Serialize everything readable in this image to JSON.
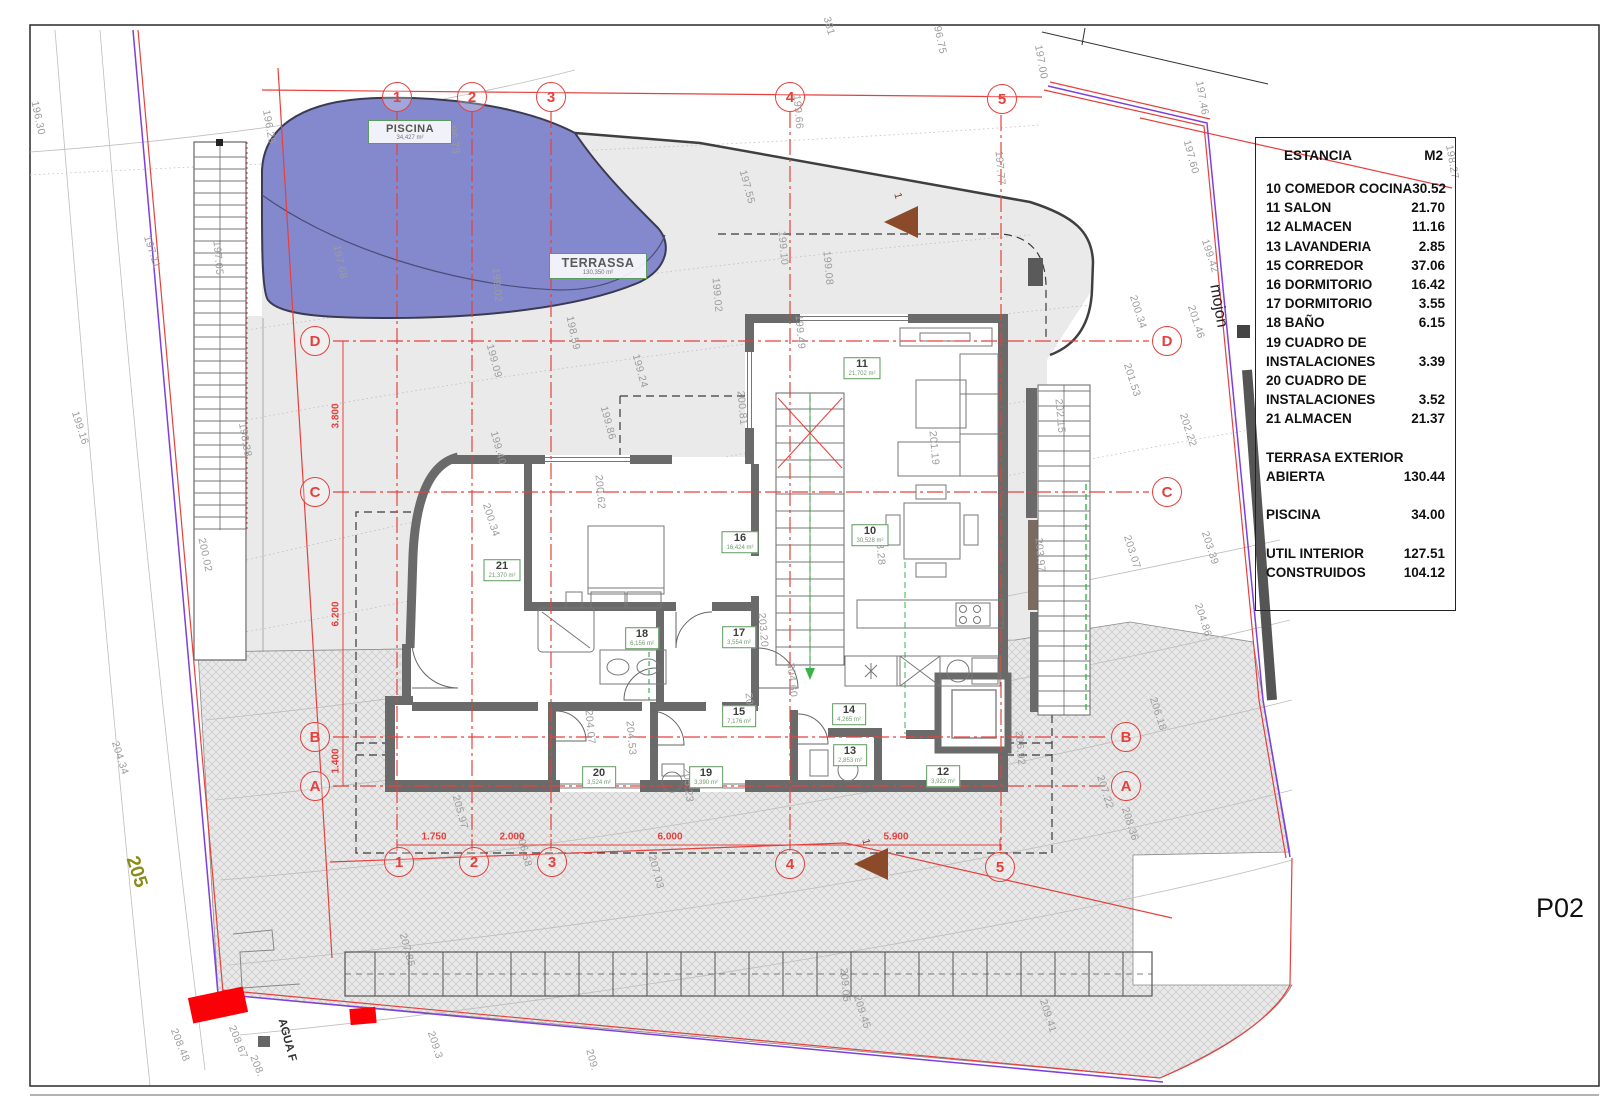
{
  "sheet": {
    "code": "P02"
  },
  "legend": {
    "title": "ESTANCIA",
    "unit": "M2",
    "rows": [
      {
        "label": "10 COMEDOR COCINA",
        "value": "30.52"
      },
      {
        "label": "11 SALON",
        "value": "21.70"
      },
      {
        "label": "12 ALMACEN",
        "value": "11.16"
      },
      {
        "label": "13 LAVANDERIA",
        "value": "2.85"
      },
      {
        "label": "15 CORREDOR",
        "value": "37.06"
      },
      {
        "label": "16 DORMITORIO",
        "value": "16.42"
      },
      {
        "label": "17 DORMITORIO",
        "value": "3.55"
      },
      {
        "label": "18 BAÑO",
        "value": "6.15"
      },
      {
        "label": "19 CUADRO DE",
        "value": ""
      },
      {
        "label": "INSTALACIONES",
        "value": "3.39"
      },
      {
        "label": "20 CUADRO DE",
        "value": ""
      },
      {
        "label": "INSTALACIONES",
        "value": "3.52"
      },
      {
        "label": "21 ALMACEN",
        "value": "21.37"
      },
      {
        "label": "",
        "value": ""
      },
      {
        "label": "TERRASA EXTERIOR",
        "value": ""
      },
      {
        "label": "ABIERTA",
        "value": "130.44"
      },
      {
        "label": "",
        "value": ""
      },
      {
        "label": "PISCINA",
        "value": "34.00"
      },
      {
        "label": "",
        "value": ""
      },
      {
        "label": "UTIL INTERIOR",
        "value": "127.51"
      },
      {
        "label": "CONSTRUIDOS",
        "value": "104.12"
      }
    ]
  },
  "areas": {
    "piscina": {
      "name": "PISCINA",
      "area": "34,427 m²"
    },
    "terrassa": {
      "name": "TERRASSA",
      "area": "130,350 m²"
    }
  },
  "rooms": [
    {
      "num": "11",
      "area": "21,702 m²",
      "x": 862,
      "y": 368
    },
    {
      "num": "10",
      "area": "30,528 m²",
      "x": 870,
      "y": 535
    },
    {
      "num": "16",
      "area": "16,424 m²",
      "x": 740,
      "y": 542
    },
    {
      "num": "21",
      "area": "21,370 m²",
      "x": 502,
      "y": 570
    },
    {
      "num": "18",
      "area": "6,156 m²",
      "x": 642,
      "y": 638
    },
    {
      "num": "17",
      "area": "3,554 m²",
      "x": 739,
      "y": 637
    },
    {
      "num": "15",
      "area": "7,176 m²",
      "x": 739,
      "y": 716
    },
    {
      "num": "14",
      "area": "4,265 m²",
      "x": 849,
      "y": 714
    },
    {
      "num": "13",
      "area": "2,853 m²",
      "x": 850,
      "y": 755
    },
    {
      "num": "19",
      "area": "3,390 m²",
      "x": 706,
      "y": 777
    },
    {
      "num": "12",
      "area": "3,922 m²",
      "x": 943,
      "y": 776
    },
    {
      "num": "20",
      "area": "3,524 m²",
      "x": 599,
      "y": 777
    }
  ],
  "grid": {
    "bubbles": [
      {
        "t": "1",
        "x": 397,
        "y": 97
      },
      {
        "t": "2",
        "x": 472,
        "y": 97
      },
      {
        "t": "3",
        "x": 551,
        "y": 97
      },
      {
        "t": "4",
        "x": 790,
        "y": 97
      },
      {
        "t": "5",
        "x": 1002,
        "y": 99
      },
      {
        "t": "1",
        "x": 399,
        "y": 862
      },
      {
        "t": "2",
        "x": 474,
        "y": 862
      },
      {
        "t": "3",
        "x": 552,
        "y": 862
      },
      {
        "t": "4",
        "x": 790,
        "y": 864
      },
      {
        "t": "5",
        "x": 1000,
        "y": 867
      },
      {
        "t": "D",
        "x": 315,
        "y": 341
      },
      {
        "t": "C",
        "x": 315,
        "y": 492
      },
      {
        "t": "B",
        "x": 315,
        "y": 737
      },
      {
        "t": "A",
        "x": 315,
        "y": 786
      },
      {
        "t": "D",
        "x": 1167,
        "y": 341
      },
      {
        "t": "C",
        "x": 1167,
        "y": 492
      },
      {
        "t": "B",
        "x": 1126,
        "y": 737
      },
      {
        "t": "A",
        "x": 1126,
        "y": 786
      }
    ]
  },
  "dims": [
    {
      "t": "1.750",
      "x": 434,
      "y": 837
    },
    {
      "t": "2.000",
      "x": 512,
      "y": 837
    },
    {
      "t": "6.000",
      "x": 670,
      "y": 837
    },
    {
      "t": "5.900",
      "x": 896,
      "y": 837
    },
    {
      "t": "3.800",
      "x": 336,
      "y": 416,
      "r": -90
    },
    {
      "t": "6.200",
      "x": 336,
      "y": 614,
      "r": -90
    },
    {
      "t": "1.400",
      "x": 336,
      "y": 761,
      "r": -90
    }
  ],
  "labels": [
    {
      "t": "196.30",
      "x": 38,
      "y": 118,
      "r": 78
    },
    {
      "t": "197.11",
      "x": 152,
      "y": 252,
      "r": 72
    },
    {
      "t": "199.16",
      "x": 80,
      "y": 428,
      "r": 72
    },
    {
      "t": "204.34",
      "x": 120,
      "y": 758,
      "r": 72
    },
    {
      "t": "196.29",
      "x": 269,
      "y": 127,
      "r": 80
    },
    {
      "t": "96.73",
      "x": 454,
      "y": 140,
      "r": 82
    },
    {
      "t": "197.68",
      "x": 340,
      "y": 262,
      "r": 78
    },
    {
      "t": "197.05",
      "x": 218,
      "y": 258,
      "r": 85
    },
    {
      "t": "198.38",
      "x": 245,
      "y": 440,
      "r": 80
    },
    {
      "t": "200.02",
      "x": 205,
      "y": 555,
      "r": 78
    },
    {
      "t": "199.09",
      "x": 494,
      "y": 361,
      "r": 75
    },
    {
      "t": "198.59",
      "x": 573,
      "y": 333,
      "r": 78
    },
    {
      "t": "199.24",
      "x": 640,
      "y": 371,
      "r": 75
    },
    {
      "t": "199.86",
      "x": 608,
      "y": 423,
      "r": 75
    },
    {
      "t": "199.40",
      "x": 498,
      "y": 448,
      "r": 75
    },
    {
      "t": "199.02",
      "x": 497,
      "y": 285,
      "r": 85
    },
    {
      "t": "200.62",
      "x": 600,
      "y": 492,
      "r": 85
    },
    {
      "t": "200.34",
      "x": 491,
      "y": 520,
      "r": 72
    },
    {
      "t": "199.49",
      "x": 800,
      "y": 332,
      "r": 85
    },
    {
      "t": "200.81",
      "x": 742,
      "y": 408,
      "r": 85
    },
    {
      "t": "201.19",
      "x": 934,
      "y": 448,
      "r": 85
    },
    {
      "t": "197.55",
      "x": 747,
      "y": 187,
      "r": 75
    },
    {
      "t": "199.10",
      "x": 783,
      "y": 248,
      "r": 85
    },
    {
      "t": "199.08",
      "x": 828,
      "y": 268,
      "r": 85
    },
    {
      "t": "199.02",
      "x": 717,
      "y": 295,
      "r": 85
    },
    {
      "t": "197.77",
      "x": 1000,
      "y": 168,
      "r": 85
    },
    {
      "t": "199.66",
      "x": 798,
      "y": 112,
      "r": 85
    },
    {
      "t": "381",
      "x": 829,
      "y": 26,
      "r": 75
    },
    {
      "t": "96.75",
      "x": 940,
      "y": 40,
      "r": 78
    },
    {
      "t": "197.00",
      "x": 1041,
      "y": 62,
      "r": 80
    },
    {
      "t": "197.46",
      "x": 1202,
      "y": 98,
      "r": 80
    },
    {
      "t": "197.60",
      "x": 1191,
      "y": 157,
      "r": 75
    },
    {
      "t": "198.27",
      "x": 1452,
      "y": 162,
      "r": 80
    },
    {
      "t": "199.42",
      "x": 1210,
      "y": 256,
      "r": 72
    },
    {
      "t": "200.34",
      "x": 1138,
      "y": 312,
      "r": 72
    },
    {
      "t": "201.46",
      "x": 1196,
      "y": 322,
      "r": 72
    },
    {
      "t": "201.53",
      "x": 1132,
      "y": 380,
      "r": 72
    },
    {
      "t": "202.22",
      "x": 1188,
      "y": 430,
      "r": 72
    },
    {
      "t": "202.15",
      "x": 1060,
      "y": 416,
      "r": 85
    },
    {
      "t": "203.07",
      "x": 1132,
      "y": 552,
      "r": 72
    },
    {
      "t": "203.39",
      "x": 1210,
      "y": 548,
      "r": 72
    },
    {
      "t": "203.97",
      "x": 1040,
      "y": 555,
      "r": 85
    },
    {
      "t": "204.86",
      "x": 1203,
      "y": 620,
      "r": 72
    },
    {
      "t": "206.18",
      "x": 1158,
      "y": 714,
      "r": 72
    },
    {
      "t": "206.92",
      "x": 1020,
      "y": 748,
      "r": 85
    },
    {
      "t": "207.22",
      "x": 1105,
      "y": 792,
      "r": 72
    },
    {
      "t": "208.36",
      "x": 1130,
      "y": 824,
      "r": 72
    },
    {
      "t": "204.60",
      "x": 792,
      "y": 680,
      "r": 85
    },
    {
      "t": "203.28",
      "x": 880,
      "y": 548,
      "r": 85
    },
    {
      "t": "203.20",
      "x": 763,
      "y": 630,
      "r": 85
    },
    {
      "t": "204.07",
      "x": 590,
      "y": 727,
      "r": 85
    },
    {
      "t": "204.53",
      "x": 631,
      "y": 738,
      "r": 85
    },
    {
      "t": "204.95",
      "x": 750,
      "y": 710,
      "r": 85
    },
    {
      "t": "205.23",
      "x": 688,
      "y": 785,
      "r": 85
    },
    {
      "t": "205.97",
      "x": 460,
      "y": 812,
      "r": 75
    },
    {
      "t": "206.58",
      "x": 524,
      "y": 850,
      "r": 75
    },
    {
      "t": "207.03",
      "x": 656,
      "y": 872,
      "r": 75
    },
    {
      "t": "207.85",
      "x": 407,
      "y": 950,
      "r": 75
    },
    {
      "t": "209.05",
      "x": 845,
      "y": 985,
      "r": 85
    },
    {
      "t": "209.45",
      "x": 862,
      "y": 1012,
      "r": 72
    },
    {
      "t": "209.41",
      "x": 1048,
      "y": 1016,
      "r": 72
    },
    {
      "t": "209.3",
      "x": 435,
      "y": 1045,
      "r": 72
    },
    {
      "t": "209.",
      "x": 592,
      "y": 1060,
      "r": 75
    },
    {
      "t": "208.48",
      "x": 180,
      "y": 1045,
      "r": 68
    },
    {
      "t": "208.67",
      "x": 238,
      "y": 1042,
      "r": 68
    },
    {
      "t": "208.",
      "x": 257,
      "y": 1066,
      "r": 68
    },
    {
      "t": "1",
      "x": 898,
      "y": 196,
      "r": 75,
      "c": "#7a3a26"
    },
    {
      "t": "1",
      "x": 866,
      "y": 842,
      "r": 75,
      "c": "#7a3a26"
    }
  ],
  "annotations": {
    "mojon": "mojon",
    "zone": "205",
    "agua": "AGUA F"
  },
  "colors": {
    "grid_red": "#e6403c",
    "boundary_purple": "#7d3fe0",
    "pool_blue": "#8489ce",
    "wall_gray": "#6a6a6a",
    "marker_red": "#fb0007",
    "green_dash": "#3cb14a",
    "zone_olive": "#8b8b1a"
  }
}
